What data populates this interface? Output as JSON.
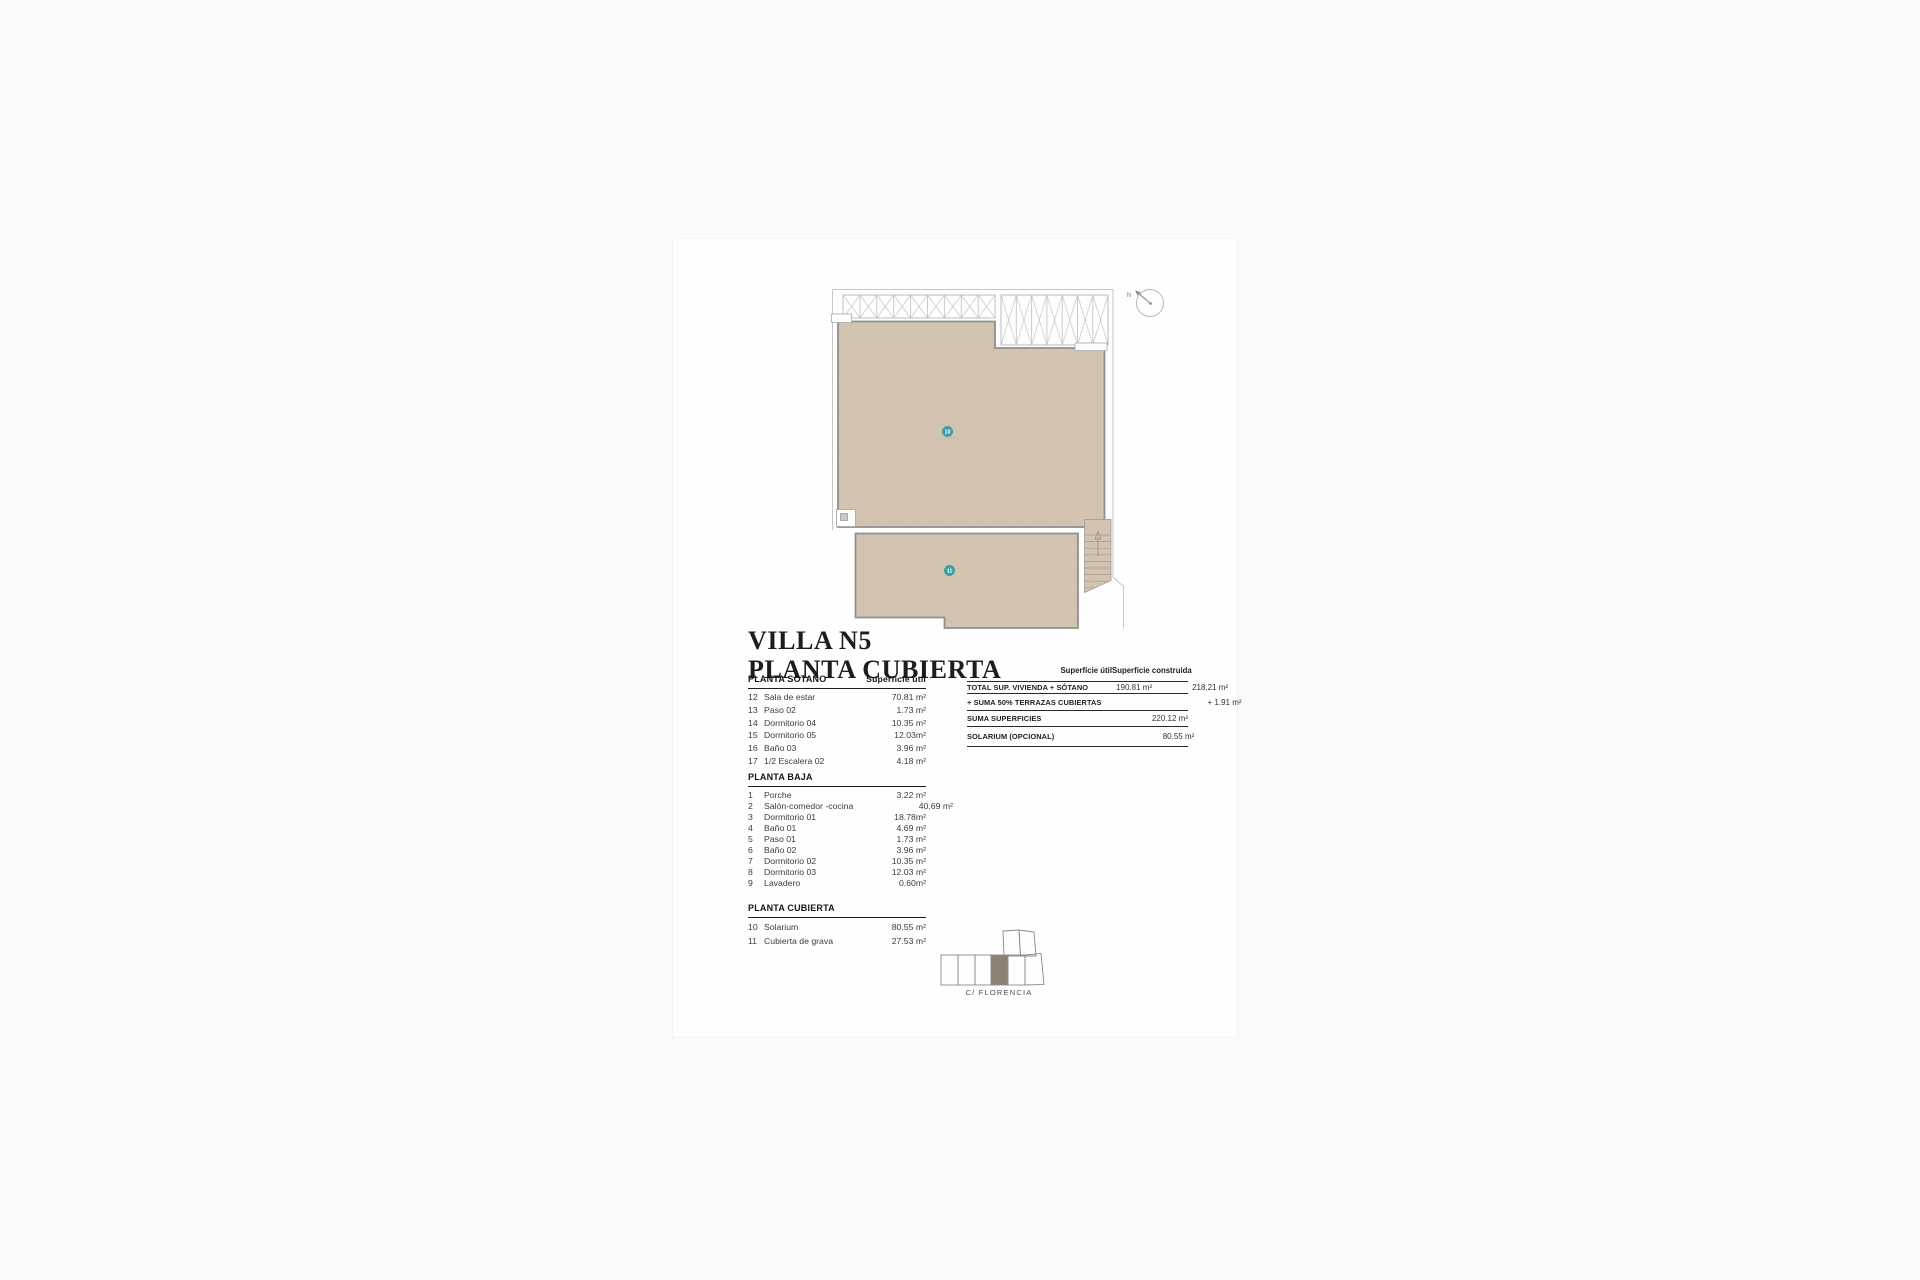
{
  "title": {
    "line1": "VILLA N5",
    "line2": "PLANTA CUBIERTA"
  },
  "plan": {
    "labels": {
      "area10": "10",
      "area11": "11"
    },
    "compass_n": "N",
    "colors": {
      "floor_tan": "#d3c4b2",
      "floor_grid": "#c7b8a5",
      "wall": "#8f8f8f",
      "outline": "#c6c6c6",
      "label_teal": "#3f9fa2",
      "site_plot_fill": "#8b8275"
    }
  },
  "area_table": {
    "value_header": "Superficie útil",
    "sections": [
      {
        "header": "PLANTA SÓTANO",
        "rows": [
          {
            "num": "12",
            "label": "Sala de estar",
            "value": "70.81 m²"
          },
          {
            "num": "13",
            "label": "Paso 02",
            "value": "1.73 m²"
          },
          {
            "num": "14",
            "label": "Dormitorio 04",
            "value": "10.35 m²"
          },
          {
            "num": "15",
            "label": "Dormitorio 05",
            "value": "12.03m²"
          },
          {
            "num": "16",
            "label": "Baño 03",
            "value": "3.96 m²"
          },
          {
            "num": "17",
            "label": "1/2 Escalera 02",
            "value": "4.18 m²"
          }
        ]
      },
      {
        "header": "PLANTA BAJA",
        "rows": [
          {
            "num": "1",
            "label": "Porche",
            "value": "3.22 m²"
          },
          {
            "num": "2",
            "label": "Salón-comedor -cocina",
            "value": "40.69 m²"
          },
          {
            "num": "3",
            "label": "Dormitorio 01",
            "value": "18.78m²"
          },
          {
            "num": "4",
            "label": "Baño 01",
            "value": "4.69 m²"
          },
          {
            "num": "5",
            "label": "Paso 01",
            "value": "1.73 m²"
          },
          {
            "num": "6",
            "label": "Baño 02",
            "value": "3.96 m²"
          },
          {
            "num": "7",
            "label": "Dormitorio 02",
            "value": "10.35 m²"
          },
          {
            "num": "8",
            "label": "Dormitorio 03",
            "value": "12.03 m²"
          },
          {
            "num": "9",
            "label": "Lavadero",
            "value": "0.60m²"
          }
        ]
      },
      {
        "header": "PLANTA CUBIERTA",
        "rows": [
          {
            "num": "10",
            "label": "Solarium",
            "value": "80.55 m²"
          },
          {
            "num": "11",
            "label": "Cubierta de grava",
            "value": "27.53 m²"
          }
        ]
      }
    ]
  },
  "summary_table": {
    "col_headers": [
      "Superficie útil",
      "Superficie construida"
    ],
    "rows": [
      {
        "label": "TOTAL SUP. VIVIENDA + SÓTANO",
        "util": "190.81 m²",
        "construida": "218.21 m²"
      },
      {
        "label": "+ SUMA 50% TERRAZAS CUBIERTAS",
        "util": "",
        "construida": "+ 1.91 m²"
      },
      {
        "label": "SUMA SUPERFICIES",
        "util": "",
        "construida": "220.12 m²"
      },
      {
        "label": "SOLARIUM (OPCIONAL)",
        "util": "",
        "construida": "80.55 m²"
      }
    ]
  },
  "site_plan": {
    "street_label": "C/ FLORENCIA"
  }
}
